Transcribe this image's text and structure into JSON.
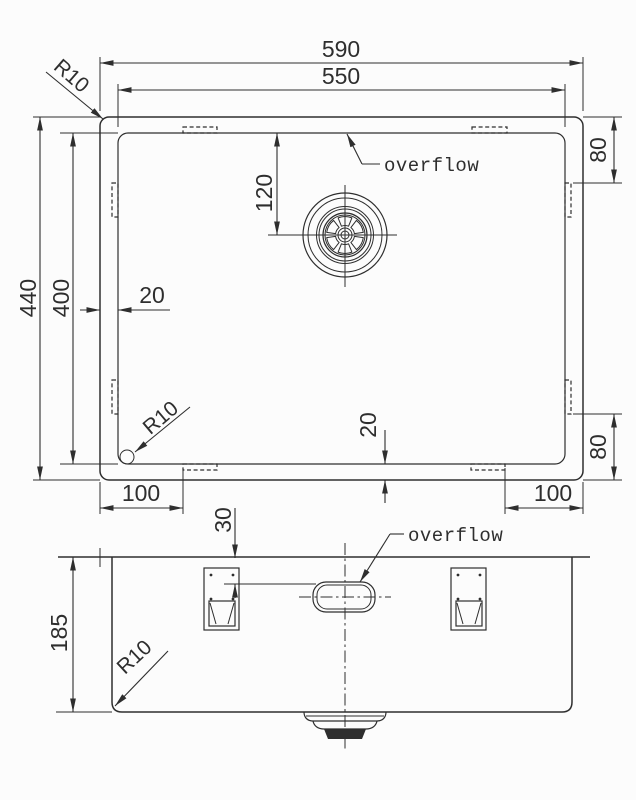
{
  "style": {
    "ink": "#2e2e2e",
    "background": "#fcfcfc"
  },
  "top_view": {
    "dims": {
      "outer_width": "590",
      "inner_width": "550",
      "outer_height": "440",
      "inner_height": "400",
      "drain_offset": "120",
      "rim_left": "20",
      "rim_bottom": "20",
      "clip_edge_top_right": "80",
      "clip_edge_bottom_right": "80",
      "clip_offset_bottom_left": "100",
      "clip_offset_bottom_right": "100"
    },
    "labels": {
      "radius_outer": "R10",
      "radius_inner": "R10",
      "overflow": "overflow"
    }
  },
  "front_view": {
    "dims": {
      "depth": "185",
      "overflow_top_offset": "30"
    },
    "labels": {
      "radius": "R10",
      "overflow": "overflow"
    }
  }
}
